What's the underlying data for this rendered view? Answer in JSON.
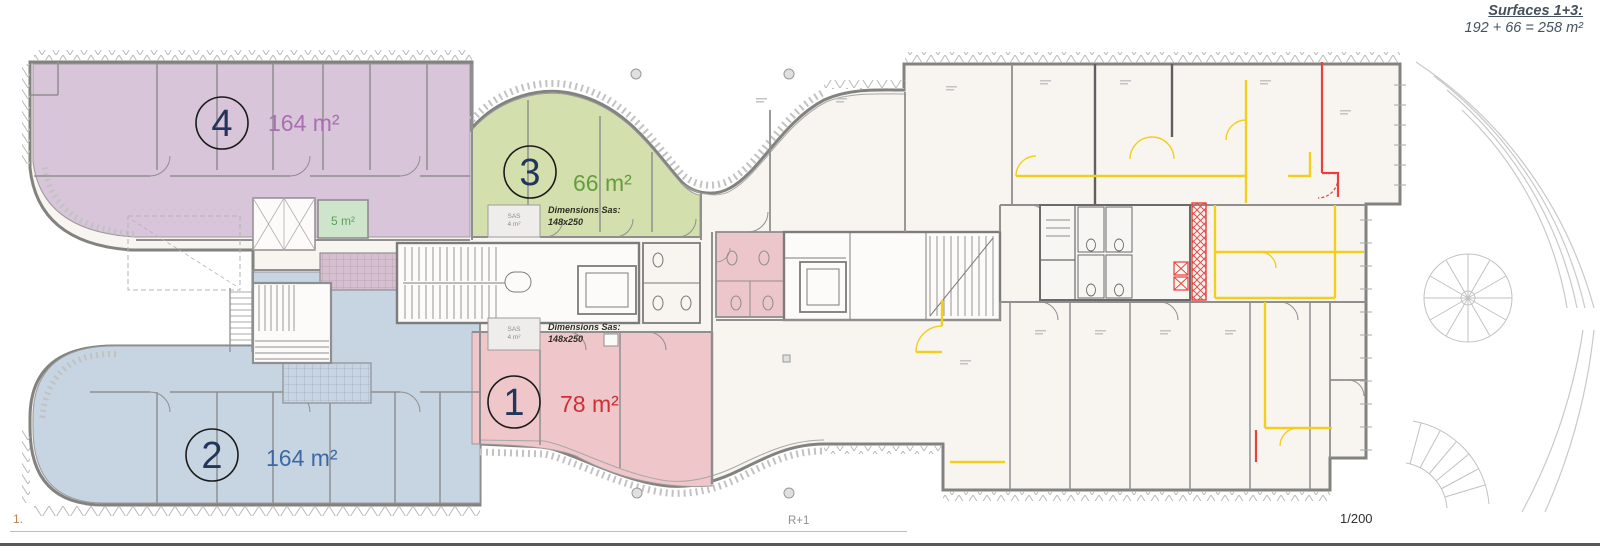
{
  "annotation": {
    "title": "Surfaces 1+3:",
    "formula": "192 + 66 = 258 m²"
  },
  "zones": {
    "z1": {
      "number": "1",
      "area": "78 m²",
      "fill": "#efc6c9",
      "label_color": "#cf2e33"
    },
    "z2": {
      "number": "2",
      "area": "164 m²",
      "fill": "#c7d4e2",
      "label_color": "#3b69a4"
    },
    "z3": {
      "number": "3",
      "area": "66 m²",
      "fill": "#d3e0ad",
      "label_color": "#679c3e"
    },
    "z4": {
      "number": "4",
      "area": "164 m²",
      "fill": "#d8c5d9",
      "label_color": "#a96fb1"
    }
  },
  "small_room": {
    "area": "5 m²",
    "fill": "#cfe5cb",
    "label_color": "#57a25b"
  },
  "sas_top": {
    "title": "Dimensions Sas:",
    "dims": "148x250",
    "room": "SAS",
    "room_area": "4 m²"
  },
  "sas_bottom": {
    "title": "Dimensions Sas:",
    "dims": "148x250",
    "room": "SAS",
    "room_area": "4 m²"
  },
  "footer": {
    "sheet": "1.",
    "level": "R+1",
    "scale": "1/200"
  },
  "colors": {
    "zone_number": "#22355c",
    "partition_yellow": "#f2cf1d",
    "markup_red": "#e8403a",
    "wall_grey": "#8f8f8f"
  }
}
